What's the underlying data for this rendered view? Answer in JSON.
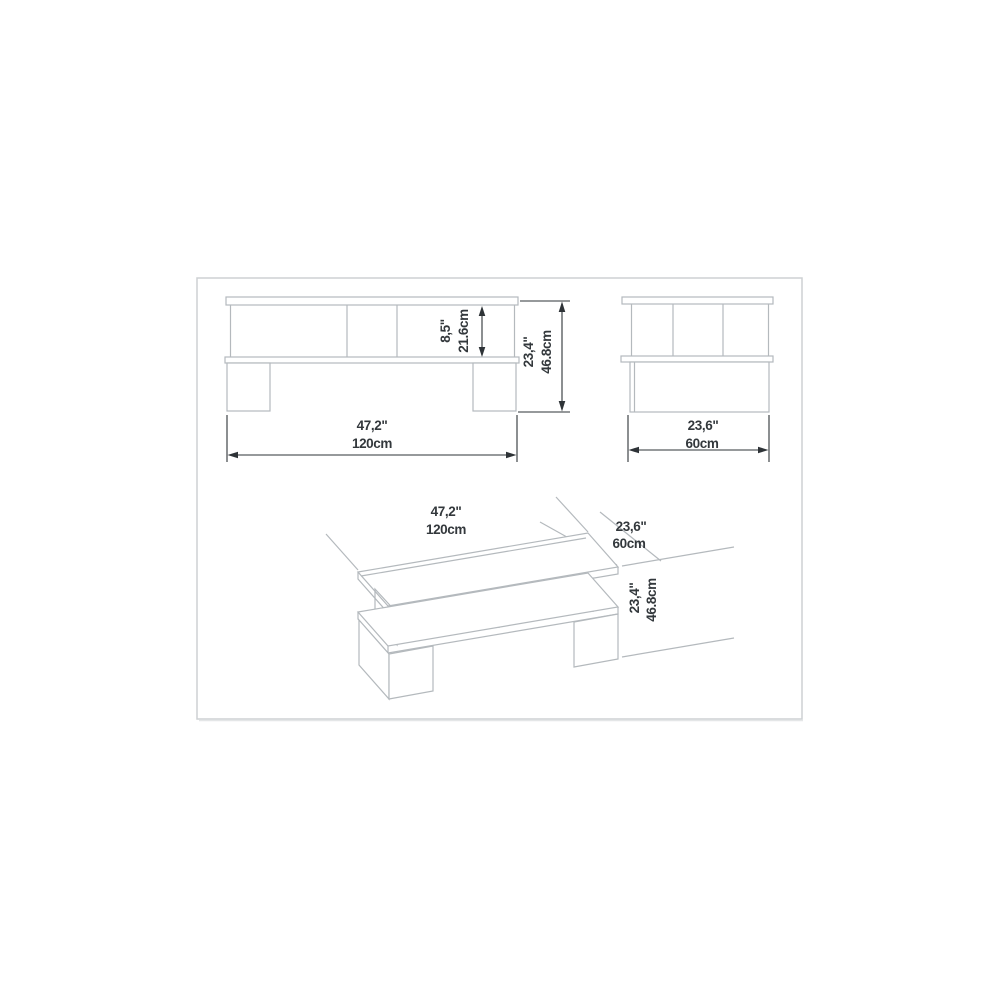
{
  "image_type": "furniture-dimension-diagram",
  "product": "coffee table with lower shelf",
  "colors": {
    "background": "#ffffff",
    "drawing_line": "#b4b9bd",
    "dimension_line": "#2e3337",
    "frame_border": "#cdd1d3"
  },
  "views": {
    "front": {
      "width_in": "47,2\"",
      "width_cm": "120cm",
      "inner_height_in": "8,5\"",
      "inner_height_cm": "21.6cm",
      "total_height_in": "23,4\"",
      "total_height_cm": "46.8cm"
    },
    "side": {
      "depth_in": "23,6\"",
      "depth_cm": "60cm"
    },
    "isometric": {
      "width_in": "47,2\"",
      "width_cm": "120cm",
      "depth_in": "23,6\"",
      "depth_cm": "60cm",
      "height_in": "23,4\"",
      "height_cm": "46.8cm"
    }
  }
}
